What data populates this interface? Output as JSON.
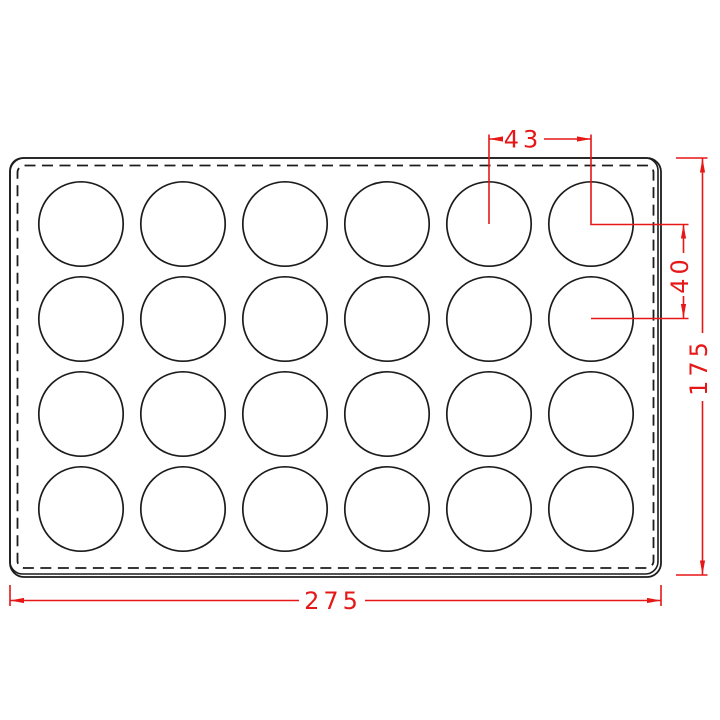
{
  "drawing": {
    "background_color": "#ffffff",
    "outline_color": "#1c1c1c",
    "dimension_color": "#e51717",
    "tray": {
      "cavity_rows": 4,
      "cavity_cols": 6,
      "cavity_count": 24
    },
    "dimensions": {
      "cavity_pitch_x": "43",
      "cavity_pitch_y": "40",
      "overall_width": "275",
      "overall_height": "175"
    }
  }
}
